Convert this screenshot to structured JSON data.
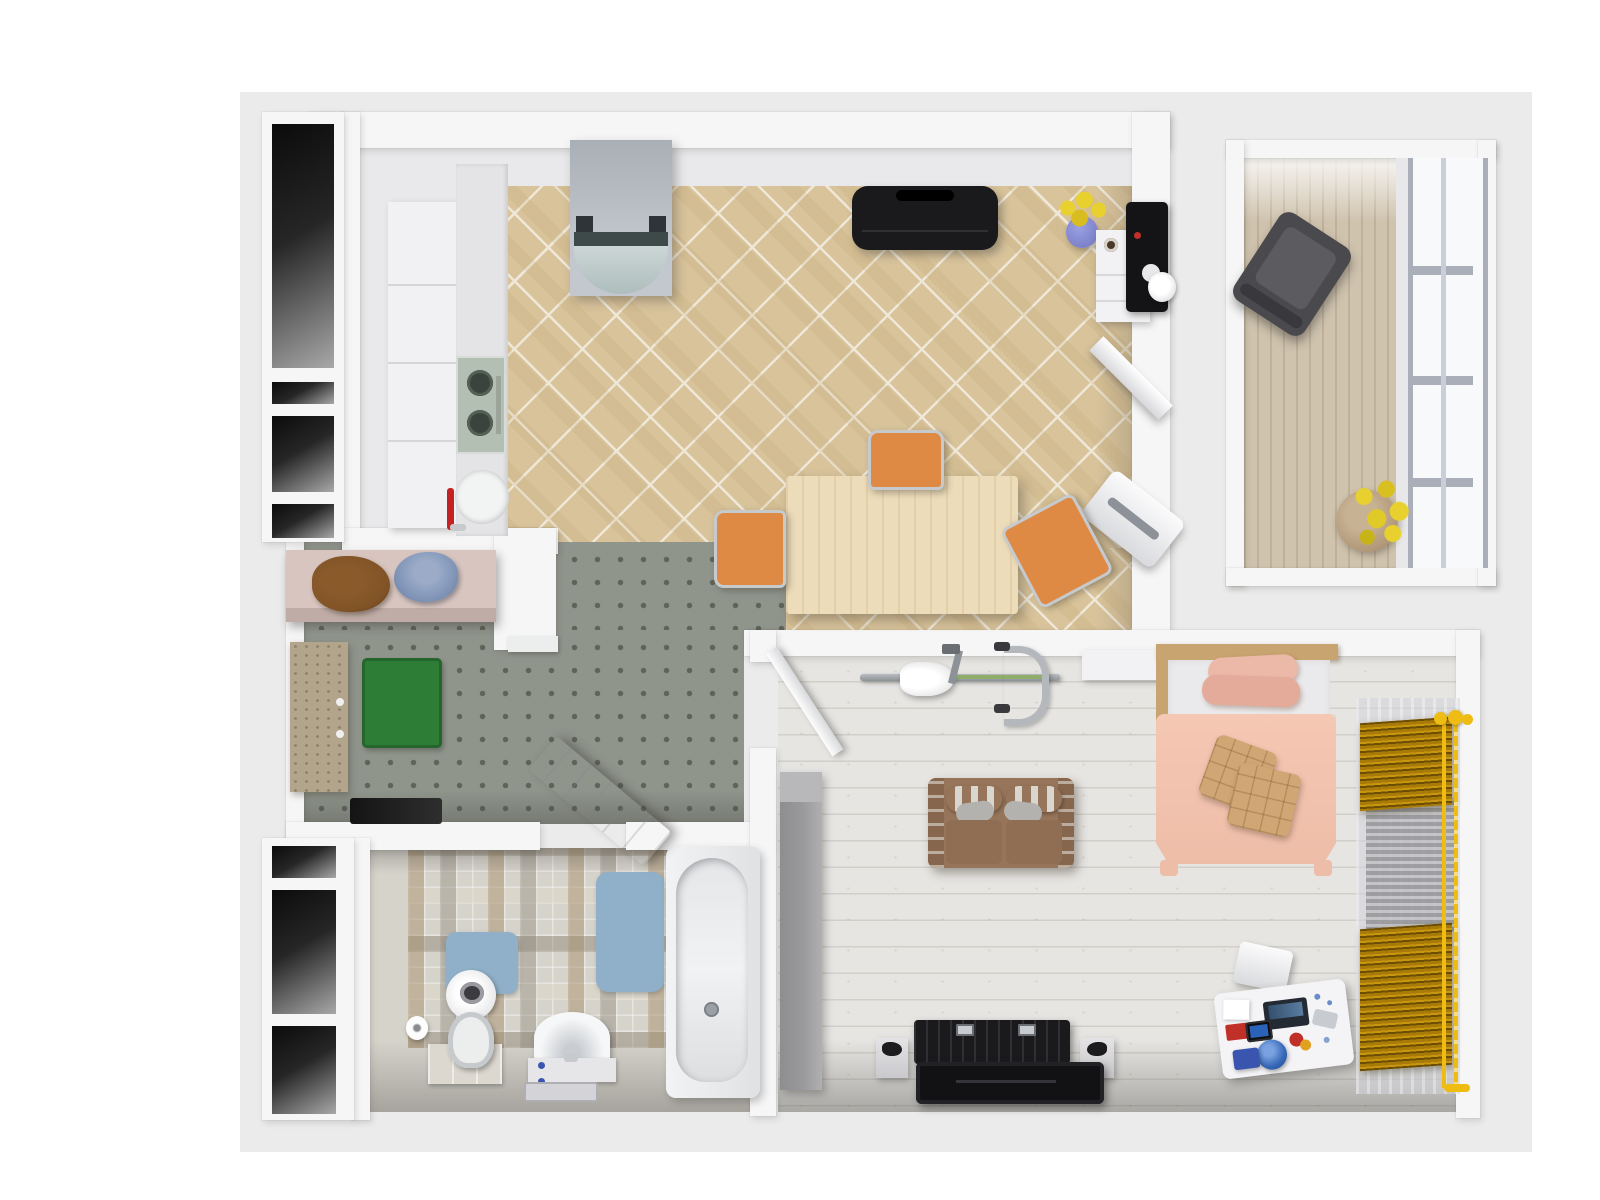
{
  "meta": {
    "type": "3d-floor-plan-render",
    "view": "top-down isometric-style render of a one-bedroom apartment",
    "visible_text": "none"
  },
  "palette": {
    "page_bg": "#ffffff",
    "plate_bg": "#ebebeb",
    "wall": "#f6f6f7",
    "niche_dark": "#111111",
    "kitchen_floor_white": "#e9e9eb",
    "tile_base": "#d8c39b",
    "tile_grout": "#efe8d8",
    "hall_floor": "#90958c",
    "hall_dot": "#5f6459",
    "bath_floor": "#d6d3cb",
    "bed_floor": "#e6e5e2",
    "plank_line": "#d2cfc9",
    "balcony_floor": "#cfc3ae",
    "window_glass": "#f7f9fb",
    "window_frame": "#a9aeb9",
    "fridge_silver": "#b7bdc3",
    "appliance_black": "#1a1a1d",
    "chrome": "#c6cacd",
    "stove_glass": "#b2bfb2",
    "faucet_red": "#c42222",
    "table_wood": "#ecdcba",
    "chair_orange": "#de8a45",
    "console_wood": "#d8c5bf",
    "clothes_brown": "#815427",
    "clothes_blue": "#8094b8",
    "door_tan": "#b3a48c",
    "mat_green": "#2e7d36",
    "mat_black": "#1f1f1f",
    "mat_blue": "#8fb0c8",
    "ceramic_white": "#f4f5f6",
    "sofa_brown": "#97755a",
    "sofa_dark": "#86674e",
    "pillow_gray": "#b4b2ae",
    "bed_headboard": "#c8a470",
    "bed_mattress": "#eaeaec",
    "bed_pillow_pink": "#ecb9a8",
    "bed_duvet": "#f5c8b4",
    "cushion_tan": "#d0a674",
    "wardrobe_gray": "#9a9a9d",
    "bike_green": "#8fae6a",
    "blind_amber": "#a87a08",
    "blind_amber_dark": "#6b4e04",
    "rod_yellow": "#eebc12",
    "curtain_sheer": "rgba(210,212,218,0.55)",
    "rug_gray": "#a4a4a8",
    "armchair_gray": "#4a4a4e",
    "plant_yellow": "#e8d02e",
    "plant_pot": "#b09878",
    "vase_blue": "#7d82cc",
    "desk_white": "#f4f4f6",
    "globe_blue": "#3668b8",
    "item_red": "#c03028",
    "item_yellow": "#e0a020",
    "item_blue": "#3a55b0"
  },
  "rooms": [
    {
      "id": "kitchen-dining",
      "name": "kitchen and dining room",
      "floor": "beige diagonal ceramic tile with white kitchen strip",
      "items": [
        "refrigerator",
        "upper and lower white cabinets",
        "two-burner cooktop",
        "round sink with red faucet",
        "black lowboard",
        "blue vase with yellow flowers",
        "white cabinet with coffee machine",
        "white corner shelf",
        "wall-mounted printer",
        "light wood dining table",
        "three orange chrome chairs"
      ]
    },
    {
      "id": "hallway",
      "name": "entry hallway",
      "floor": "gray studded vinyl",
      "items": [
        "wood console shelf with brown and blue clothes",
        "green doormat",
        "textured front door",
        "dark floor mat",
        "white door leaning open toward bathroom"
      ]
    },
    {
      "id": "bathroom",
      "name": "bathroom",
      "floor": "beige-gray mosaic tile",
      "items": [
        "toilet with open lid on tiled pedestal",
        "toilet paper holder",
        "half-round washbasin with tray",
        "bathtub",
        "large blue bath mat",
        "small blue bath mat"
      ]
    },
    {
      "id": "bedroom",
      "name": "bedroom and living area",
      "floor": "whitewashed wood planks",
      "items": [
        "open white door",
        "exercise bike",
        "tall gray wardrobe",
        "brown striped sofa",
        "double bed with pink duvet, pink pillows and two tan cushions",
        "white shelf block beside bed",
        "black media console",
        "flat tv panel",
        "two white speakers",
        "white desk with laptop, tablet, globe and accessories",
        "white stool",
        "two amber pleated window blinds with yellow rods",
        "sheer gray curtain",
        "gray knit hanging rug"
      ]
    },
    {
      "id": "balcony",
      "name": "balcony room",
      "floor": "light wood planks",
      "items": [
        "dark gray armchair",
        "round pot with yellow flowers",
        "large paned window"
      ]
    }
  ]
}
